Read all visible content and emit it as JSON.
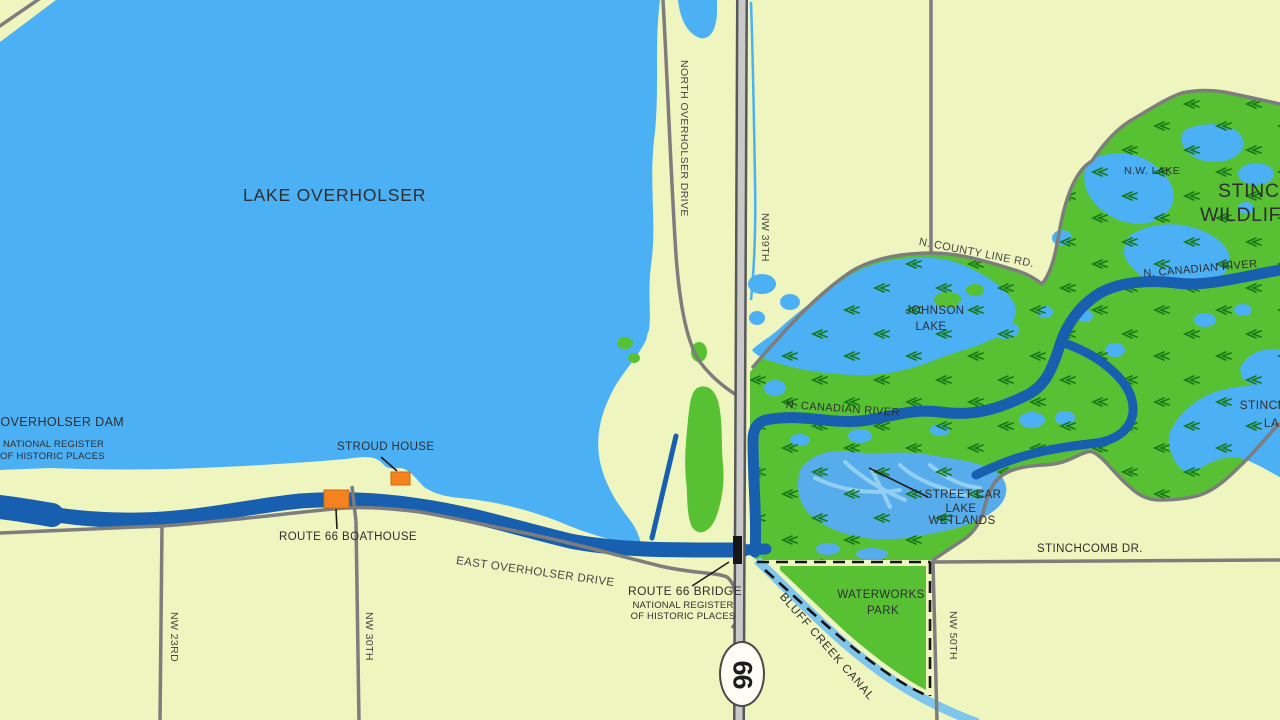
{
  "map": {
    "labels": {
      "lake": "LAKE OVERHOLSER",
      "dam": "LAKE OVERHOLSER DAM",
      "dam_sub1": "NATIONAL REGISTER",
      "dam_sub2": "OF HISTORIC PLACES",
      "stroud_house": "STROUD HOUSE",
      "boathouse": "ROUTE 66 BOATHOUSE",
      "east_overholser_drive": "EAST OVERHOLSER DRIVE",
      "north_overholser_drive": "NORTH OVERHOLSER DRIVE",
      "nw_23rd": "NW 23RD",
      "nw_30th": "NW 30TH",
      "nw_39th": "NW 39TH",
      "nw_50th": "NW 50TH",
      "county_line_rd": "N. COUNTY LINE RD.",
      "johnson_lake_line1": "JOHNSON",
      "johnson_lake_line2": "LAKE",
      "nw_lake": "N.W. LAKE",
      "refuge_line1": "STINCHCOMB",
      "refuge_line2": "WILDLIFE REFUGE",
      "canadian_river_upper": "N. CANADIAN RIVER",
      "canadian_river_lower": "N. CANADIAN RIVER",
      "stinchcomb_lake_line1": "STINCHCOMB",
      "stinchcomb_lake_line2": "LAKE",
      "street_car_line1": "STREET CAR",
      "street_car_line2": "LAKE",
      "street_car_line3": "WETLANDS",
      "waterworks_line1": "WATERWORKS",
      "waterworks_line2": "PARK",
      "bluff_creek_canal": "BLUFF CREEK CANAL",
      "stinchcomb_dr": "STINCHCOMB DR.",
      "bridge": "ROUTE 66 BRIDGE",
      "bridge_sub1": "NATIONAL REGISTER",
      "bridge_sub2": "OF HISTORIC PLACES",
      "route_shield": "66"
    },
    "colors": {
      "land": "#eef5bf",
      "lake_blue": "#4cb0f4",
      "wetland_green": "#58c133",
      "marsh_mark_green": "#167816",
      "river_blue": "#185fb0",
      "canal_blue": "#7fc6ec",
      "street_car_channel": "#93cff2",
      "road_gray": "#7d7d7d",
      "highway_dark": "#585858",
      "highway_center": "#c9c9c9",
      "poi_orange": "#f5821f",
      "bridge_black": "#161616",
      "label_dark": "#2e2e2e"
    }
  }
}
